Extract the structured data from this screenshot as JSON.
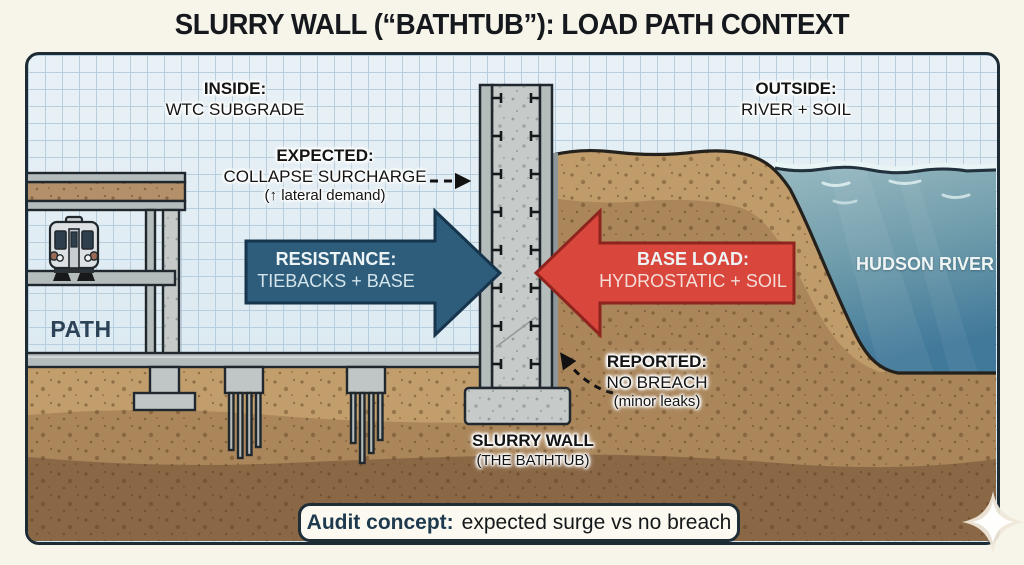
{
  "title": {
    "text": "SLURRY WALL (“BATHTUB”): LOAD PATH CONTEXT"
  },
  "labels": {
    "inside": {
      "heading": "INSIDE:",
      "sub": "WTC SUBGRADE"
    },
    "outside": {
      "heading": "OUTSIDE:",
      "sub": "RIVER + SOIL"
    },
    "expected": {
      "heading": "EXPECTED:",
      "line1": "COLLAPSE SURCHARGE",
      "line2": "(↑ lateral demand)"
    },
    "resistance": {
      "heading": "RESISTANCE:",
      "sub": "TIEBACKS + BASE"
    },
    "base_load": {
      "heading": "BASE LOAD:",
      "sub": "HYDROSTATIC + SOIL"
    },
    "reported": {
      "heading": "REPORTED:",
      "line1": "NO BREACH",
      "line2": "(minor leaks)"
    },
    "river": {
      "name": "HUDSON RIVER"
    },
    "path": {
      "name": "PATH"
    },
    "slurry_wall": {
      "line1": "SLURRY WALL",
      "line2": "(THE BATHTUB)"
    },
    "audit": {
      "lead": "Audit concept:",
      "rest": "expected surge vs no breach"
    }
  },
  "icons": {
    "train_icon": "subway-train-front",
    "sparkle_icon": "four-point-star"
  },
  "colors": {
    "page_background": "#f7f4ea",
    "frame_outline": "#1d2b34",
    "grid_background": "#ddebf3",
    "grid_line": "#b6cedd",
    "water_surface": "#97b9c1",
    "water_deep": "#41799a",
    "soil_light": "#c29e6d",
    "soil_medium": "#aa865a",
    "soil_dark": "#8a6846",
    "concrete": "#c6cbc9",
    "steel_gray": "#b5bcbc",
    "resistance_arrow": "#2e5d7c",
    "base_load_arrow": "#d9463b",
    "path_text": "#2c4257",
    "audit_lead_text": "#1d3a4f",
    "label_text": "#141414"
  }
}
